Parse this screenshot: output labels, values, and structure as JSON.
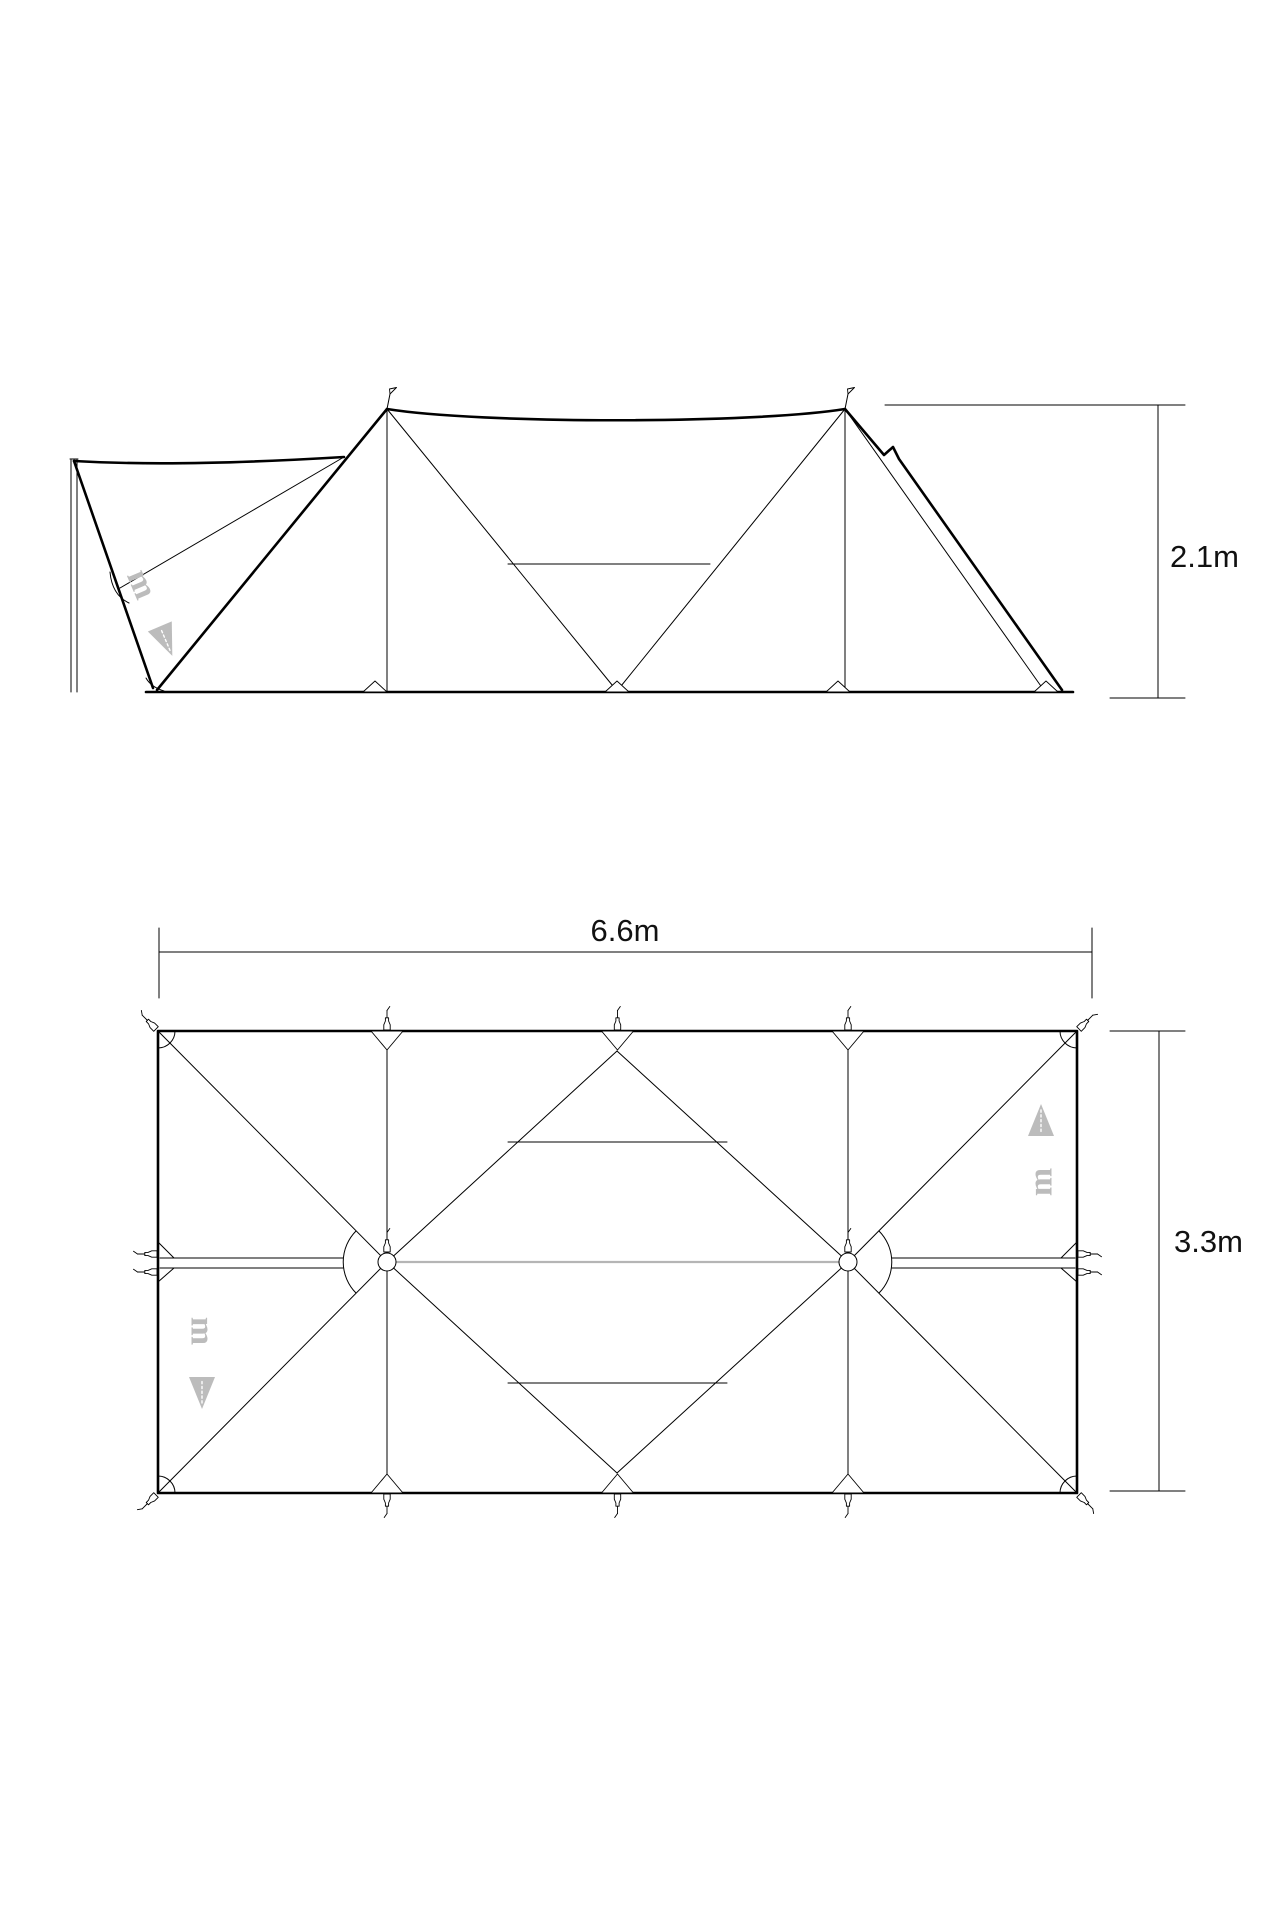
{
  "diagram": {
    "dimensions": {
      "height": "2.1m",
      "width": "6.6m",
      "depth": "3.3m"
    },
    "watermark": {
      "letter": "m"
    },
    "colors": {
      "line": "#000000",
      "watermark": "#bcbcbc",
      "pole_link": "#b5b5b5",
      "background": "#ffffff"
    }
  }
}
